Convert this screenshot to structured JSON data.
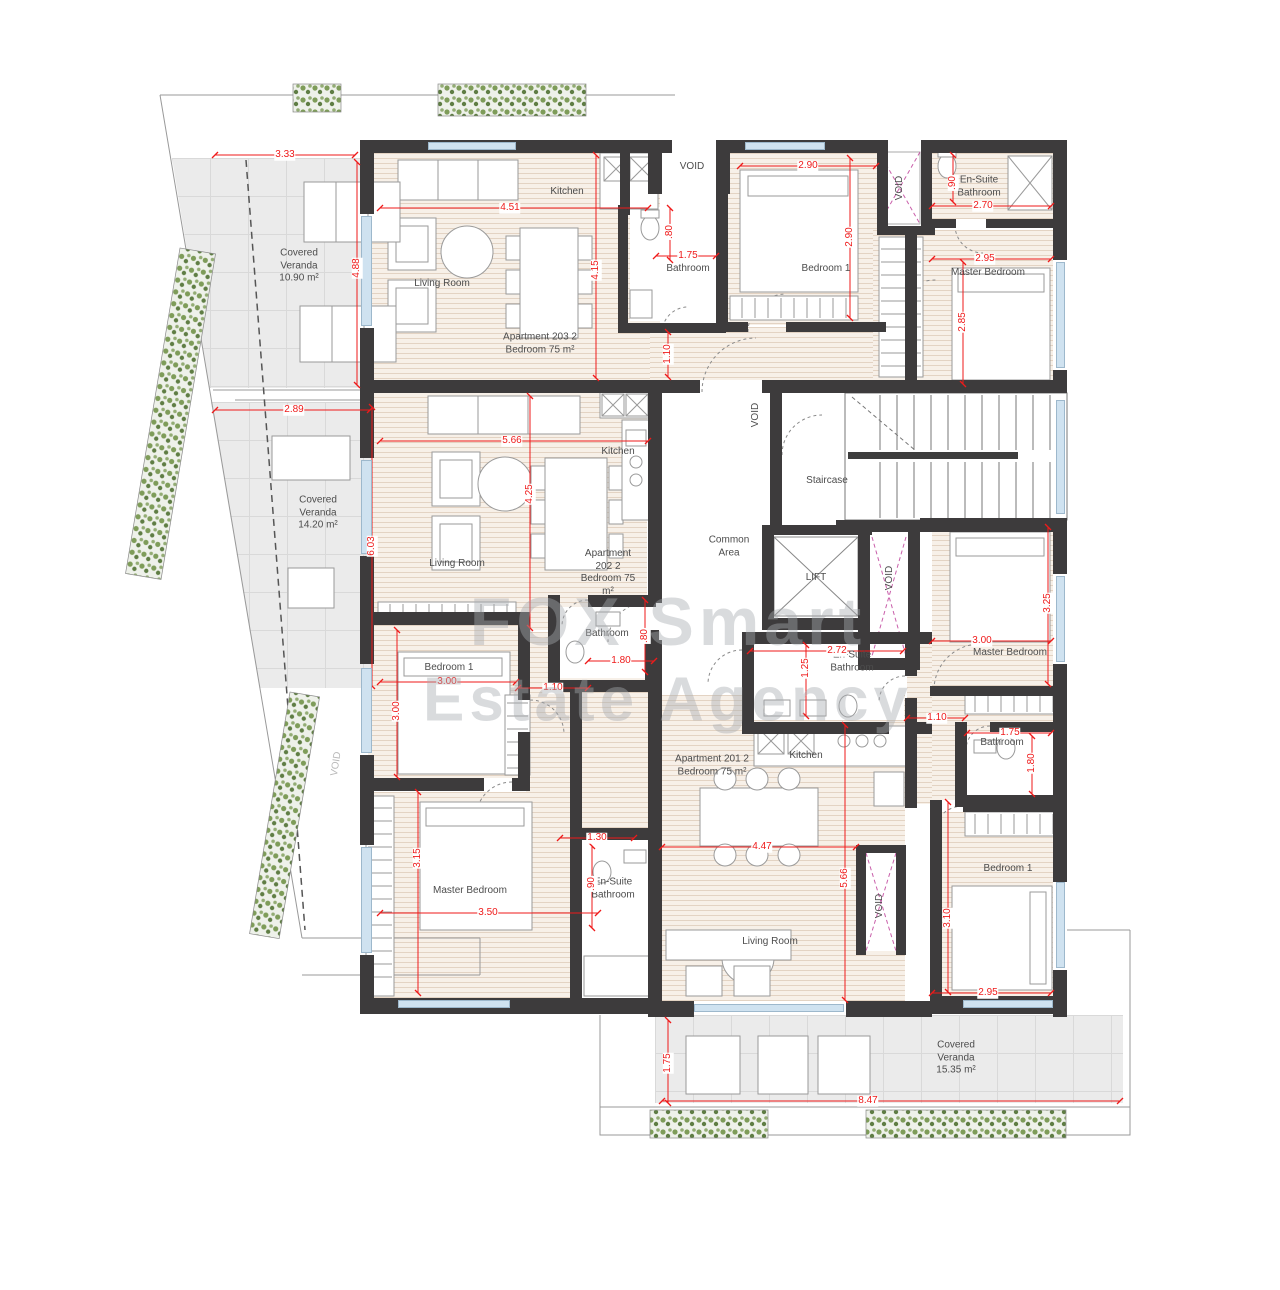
{
  "colors": {
    "dimension_red": "#ef1a1a",
    "wall": "#3d3b3c",
    "wood_floor": "#f7f0e8",
    "veranda_floor": "#ebebeb",
    "window_glass": "#cfe2f0",
    "void_pink": "#c95faa",
    "plants_green": "#7e9c59",
    "watermark_gray": "#a7abb0"
  },
  "watermark": {
    "line1": "FOX Smart",
    "line2": "Estate Agency"
  },
  "misc": {
    "void": "VOID"
  },
  "rooms": {
    "veranda_tl": "Covered Veranda 10.90 m²",
    "veranda_ml": "Covered Veranda 14.20 m²",
    "veranda_b": "Covered Veranda 15.35 m²",
    "a203_title": "Apartment 203 2 Bedroom 75 m²",
    "a203_kitchen": "Kitchen",
    "a203_living": "Living Room",
    "a203_bath": "Bathroom",
    "a203_bed1": "Bedroom 1",
    "a203_master": "Master Bedroom",
    "a203_ensuite": "En-Suite Bathroom",
    "a202_title": "Apartment 202 2 Bedroom 75 m²",
    "a202_kitchen": "Kitchen",
    "a202_living": "Living Room",
    "a202_bath": "Bathroom",
    "a202_bed1": "Bedroom 1",
    "a202_master": "Master Bedroom",
    "a202_ensuite": "En-Suite Bathroom",
    "a201_title": "Apartment 201 2 Bedroom 75 m²",
    "a201_kitchen": "Kitchen",
    "a201_living": "Living Room",
    "a201_bath": "Bathroom",
    "a201_bed1": "Bedroom 1",
    "a201_master": "Master Bedroom",
    "a201_ensuite": "En-Suite Bathroom",
    "core_common": "Common Area",
    "core_stair": "Staircase",
    "core_lift": "LIFT"
  },
  "dims": {
    "d1": "3.33",
    "d2": "4.88",
    "d3": "4.51",
    "d4": "4.15",
    "d5": "2.90",
    "d6": "2.90",
    "d7": "1.75",
    "d8": ".80",
    "d9": "1.10",
    "d10": "2.70",
    "d11": ".90",
    "d12": "2.95",
    "d13": "2.85",
    "d14": "2.89",
    "d15": "6.03",
    "d16": "5.66",
    "d17": "4.25",
    "d18": "3.00",
    "d19": "3.00",
    "d20": "1.10",
    "d21": ".80",
    "d22": "1.80",
    "d23": "3.15",
    "d24": "3.50",
    "d25": "1.30",
    "d26": ".90",
    "d27": "2.72",
    "d28": "1.25",
    "d29": "3.00",
    "d30": "3.25",
    "d31": "1.10",
    "d32": "1.75",
    "d33": "1.80",
    "d34": "4.47",
    "d35": "5.66",
    "d36": "3.10",
    "d37": "2.95",
    "d38": "8.47",
    "d39": "1.75"
  }
}
